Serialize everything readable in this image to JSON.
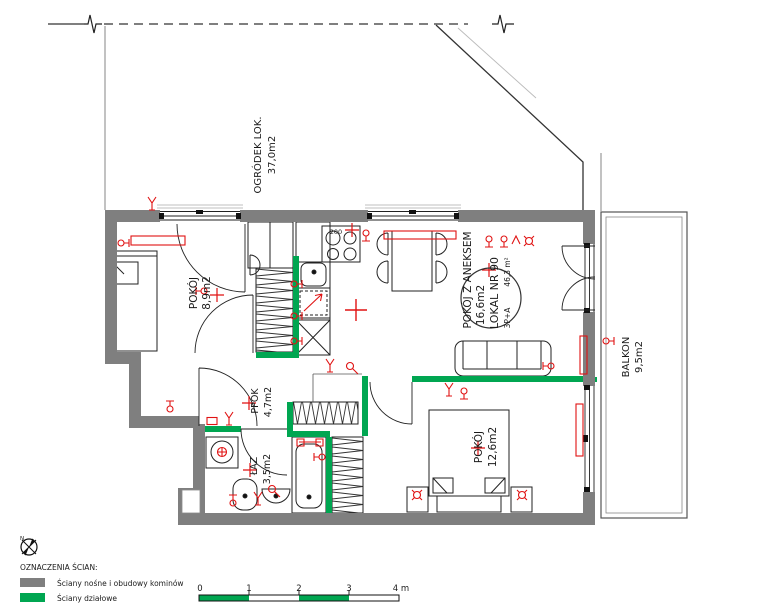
{
  "plan": {
    "rooms": [
      {
        "id": "garden",
        "name": "OGRÓDEK LOK.",
        "area": "37,0m2"
      },
      {
        "id": "room-1",
        "name": "POKÓJ",
        "area": "8,9m2"
      },
      {
        "id": "living",
        "name": "POKÓJ Z ANEKSEM",
        "area": "16,6m2"
      },
      {
        "id": "hall",
        "name": "PPOK",
        "area": "4,7m2"
      },
      {
        "id": "bath",
        "name": "ŁAZ",
        "area": "3,5m2"
      },
      {
        "id": "room-2",
        "name": "POKÓJ",
        "area": "12,6m2"
      },
      {
        "id": "balcony",
        "name": "BALKON",
        "area": "9,5m2"
      }
    ],
    "unit": {
      "name": "LOKAL NR 90",
      "type": "3P+A",
      "area": "46,3 m²"
    },
    "labels": {
      "stove": "200"
    }
  },
  "legend": {
    "compass_letter": "N",
    "title": "OZNACZENIA ŚCIAN:",
    "items": [
      {
        "label": "Ściany nośne i obudowy kominów",
        "color": "#7f7f7f"
      },
      {
        "label": "Ściany działowe",
        "color": "#00a651"
      }
    ]
  },
  "scalebar": {
    "ticks": [
      "0",
      "1",
      "2",
      "3",
      "4 m"
    ]
  },
  "colors": {
    "load_bearing_wall": "#7f7f7f",
    "partition_wall": "#00a651",
    "electrical": "#e01212",
    "outline": "#1a1a1a",
    "boundary": "#555555"
  }
}
